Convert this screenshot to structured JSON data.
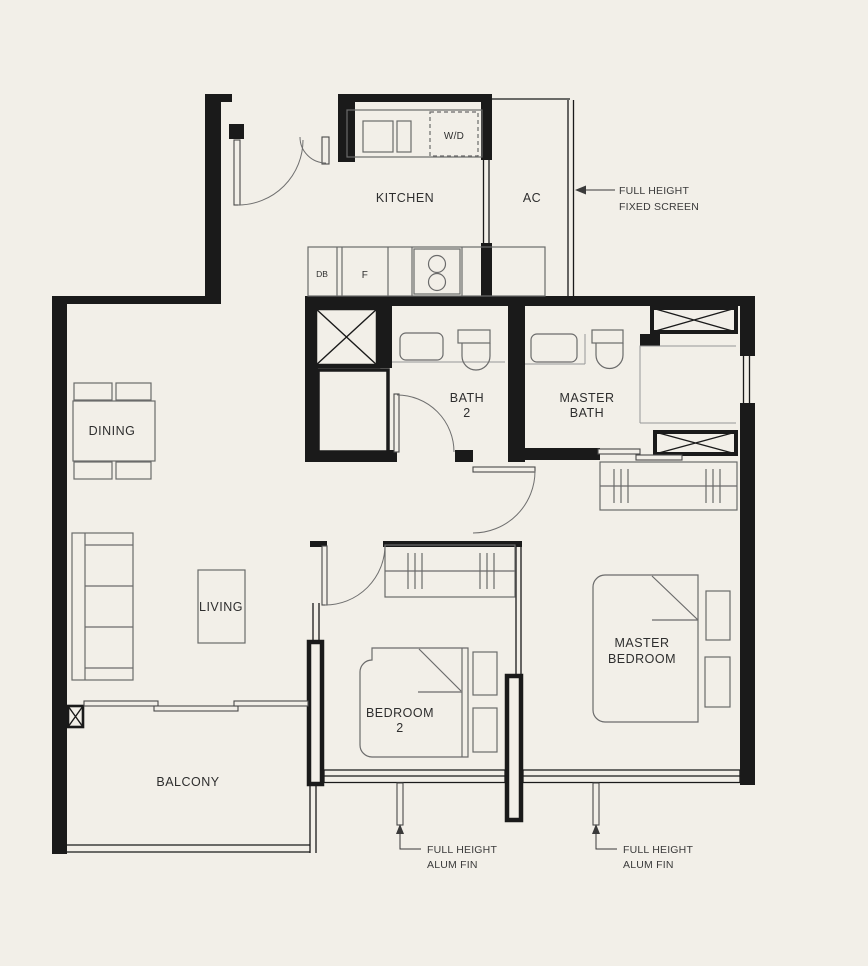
{
  "colors": {
    "background": "#f2efe8",
    "wall": "#1a1a1a",
    "furniture_line": "#6b6b6b",
    "text": "#2e2e2e"
  },
  "labels": {
    "kitchen": "KITCHEN",
    "ac": "AC",
    "dining": "DINING",
    "living": "LIVING",
    "balcony": "BALCONY",
    "bath2_l1": "BATH",
    "bath2_l2": "2",
    "master_bath_l1": "MASTER",
    "master_bath_l2": "BATH",
    "bedroom2_l1": "BEDROOM",
    "bedroom2_l2": "2",
    "master_bedroom_l1": "MASTER",
    "master_bedroom_l2": "BEDROOM"
  },
  "fixtures": {
    "washer_dryer": "W/D",
    "distribution_board": "DB",
    "fridge": "F"
  },
  "annotations": {
    "fixed_screen_l1": "FULL HEIGHT",
    "fixed_screen_l2": "FIXED SCREEN",
    "alum_fin_left_l1": "FULL HEIGHT",
    "alum_fin_left_l2": "ALUM FIN",
    "alum_fin_right_l1": "FULL HEIGHT",
    "alum_fin_right_l2": "ALUM FIN"
  },
  "markers": {
    "shaft": "x-cross",
    "ac_ledge_top": "x-cross",
    "ac_ledge_bottom": "x-cross",
    "column": "x-cross"
  }
}
